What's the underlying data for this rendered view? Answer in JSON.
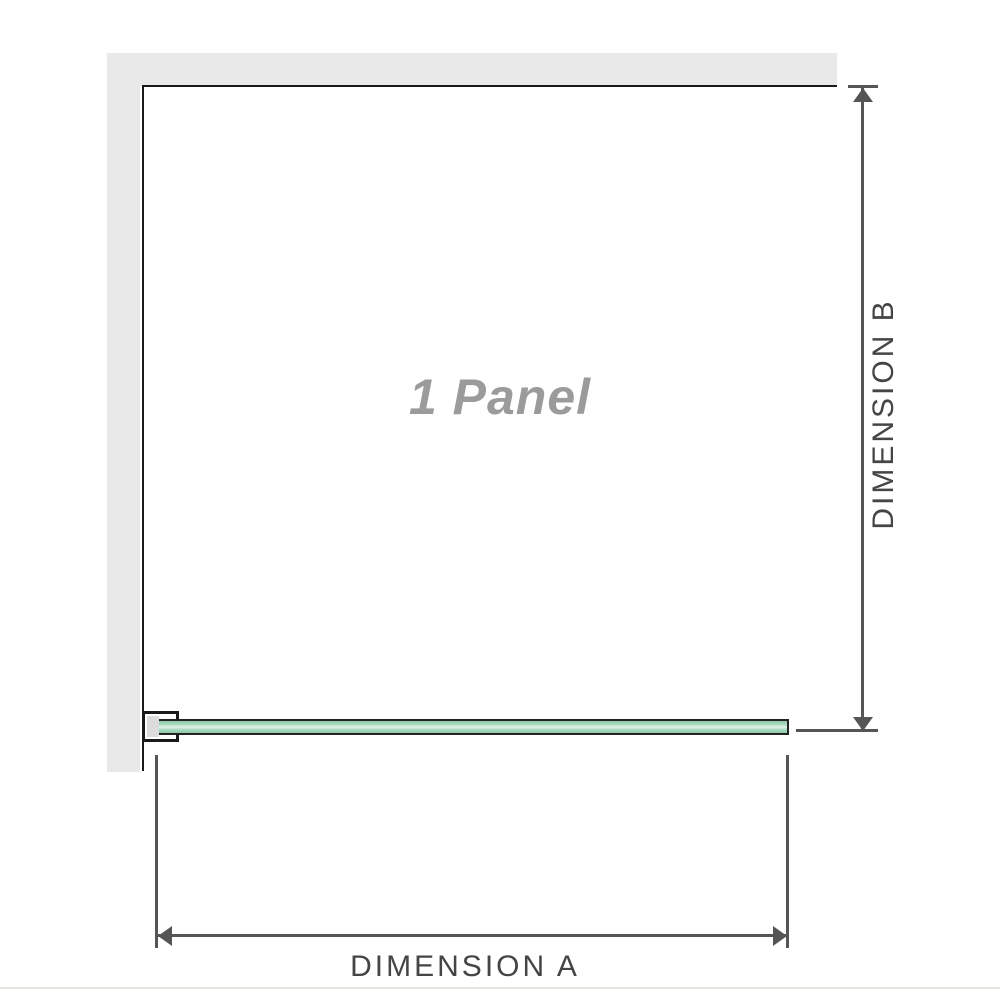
{
  "diagram": {
    "panel_label": "1 Panel",
    "dimension_a_label": "DIMENSION A",
    "dimension_b_label": "DIMENSION B"
  },
  "colors": {
    "wall": "#e9e9e9",
    "outline": "#1a1a1a",
    "dim": "#555555",
    "dimText": "#454545",
    "panelText": "#9b9b9b",
    "glassBorder": "#222222",
    "glassMid": "#8cc9a7",
    "glassHi": "#e3f3e9",
    "bracketPad": "#dcdcdc",
    "hairline": "#e4e4df"
  }
}
